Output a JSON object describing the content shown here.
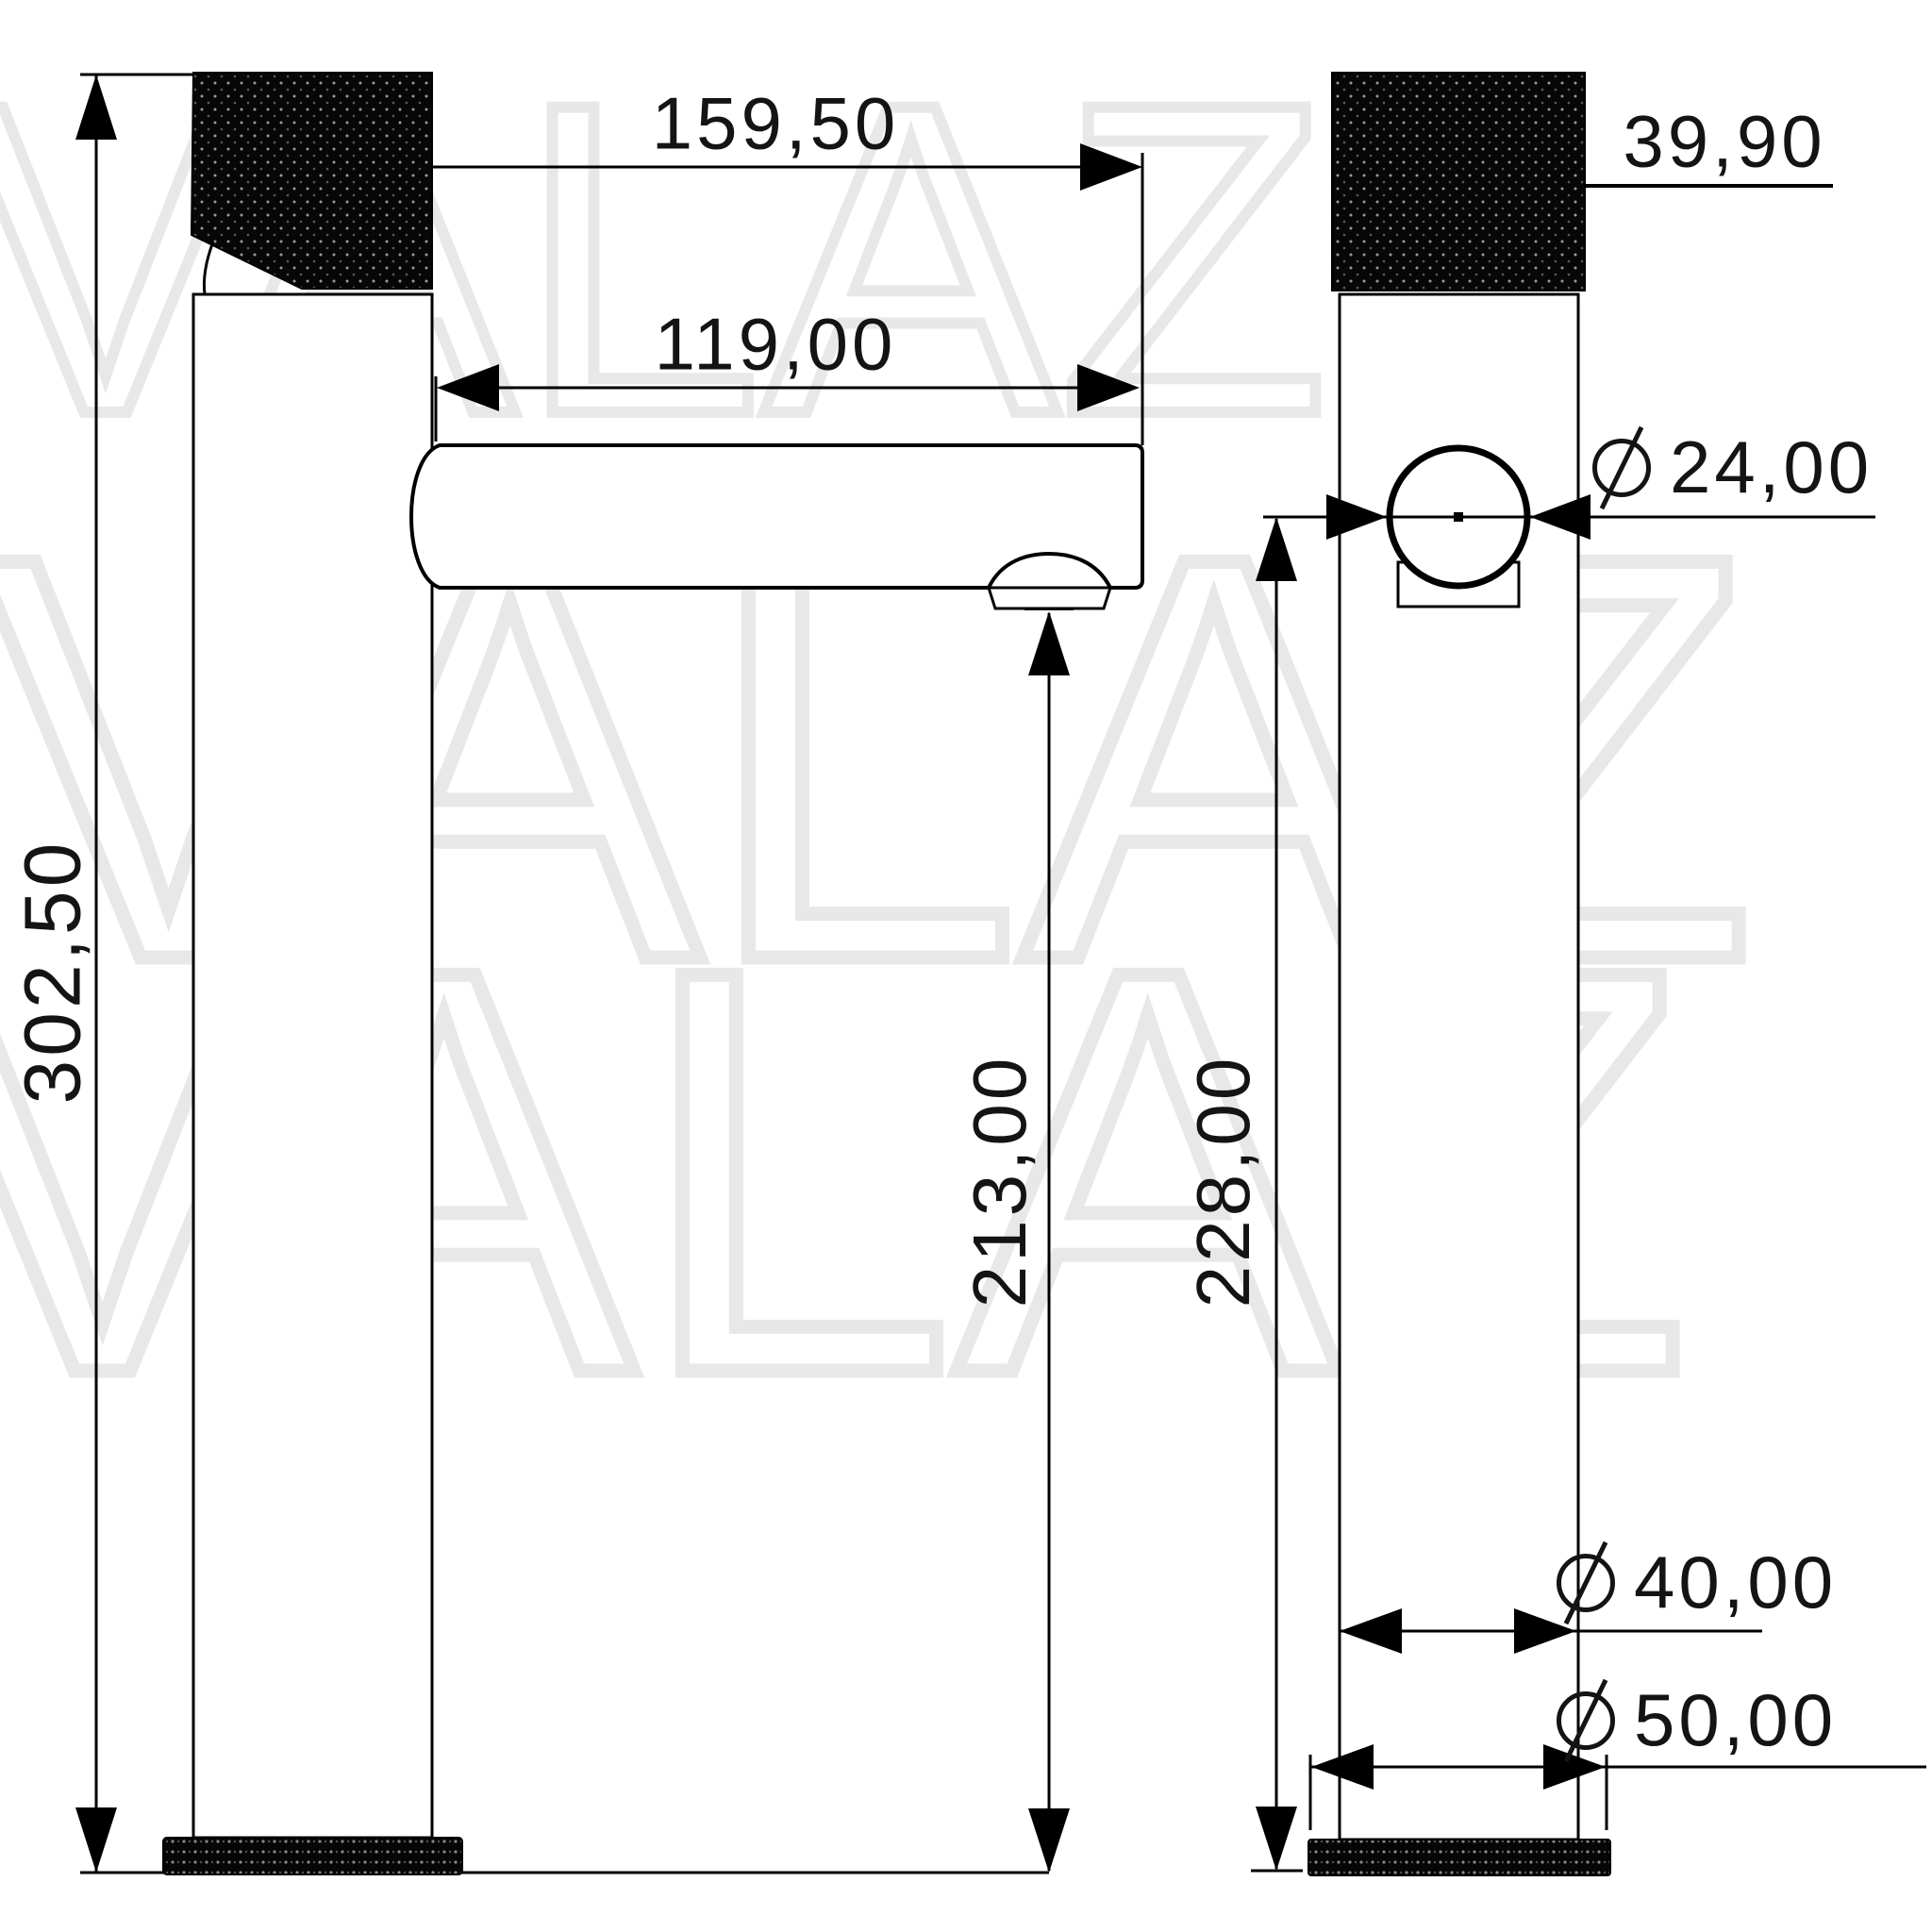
{
  "watermark": {
    "text": "VALAZ"
  },
  "drawing": {
    "type": "technical-dimension-drawing",
    "subject": "tall single-lever basin faucet, side and front views",
    "line_color": "#000000",
    "watermark_color": "#e8e8e8",
    "background": "#ffffff"
  },
  "labels": {
    "total_width": "159,50",
    "spout_reach": "119,00",
    "total_height": "302,50",
    "spout_height": "213,00",
    "outlet_height": "228,00",
    "handle_height": "39,90",
    "spout_diameter": "24,00",
    "body_diameter": "40,00",
    "base_diameter": "50,00"
  }
}
